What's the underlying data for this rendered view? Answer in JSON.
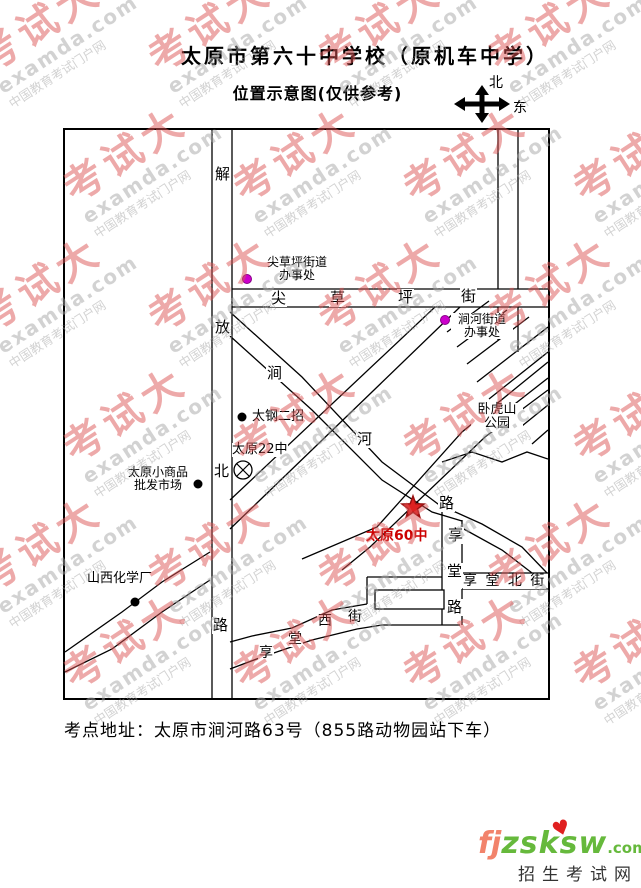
{
  "title": {
    "line1": "太原市第六十中学校（原机车中学）",
    "line2": "位置示意图(仅供参考)"
  },
  "compass": {
    "north": "北",
    "east": "东"
  },
  "streets": {
    "jiefang": [
      "解",
      "放",
      "北",
      "路"
    ],
    "jiancaoping": [
      "尖",
      "草",
      "坪",
      "街"
    ],
    "jianhe": [
      "涧",
      "河",
      "路"
    ],
    "xiangtang": [
      "享",
      "堂",
      "路"
    ],
    "xiangtang_north": "享 堂 北 街",
    "xiangtang_west": [
      "享",
      "堂",
      "西",
      "街"
    ]
  },
  "pois": {
    "jcp_office": {
      "line1": "尖草坪街道",
      "line2": "办事处"
    },
    "jh_office": {
      "line1": "涧河街道",
      "line2": "办事处"
    },
    "taigang": "太钢二招",
    "taiyuan22": "太原22中",
    "market": {
      "line1": "太原小商品",
      "line2": "批发市场"
    },
    "chemical": "山西化学厂",
    "park": {
      "line1": "卧虎山",
      "line2": "公园"
    },
    "school60": "太原60中"
  },
  "address": "考点地址：太原市涧河路63号（855路动物园站下车）",
  "logo": {
    "fj": "fj",
    "zsksw": "zsksw",
    "com": ".com",
    "heart": "♥",
    "sub": "招生考试网"
  },
  "watermark": {
    "brand": "考试大",
    "domain": "examda.com",
    "slogan": "中国教育考试门户网"
  },
  "colors": {
    "star": "#dd2222",
    "school_text": "#cc0000",
    "office_dot": "#cc00cc",
    "poi_dot": "#000000",
    "watermark_red": "#dd5555",
    "watermark_gray": "#a6a6a6",
    "logo_orange": "#f2836b",
    "logo_green": "#66b93c"
  }
}
